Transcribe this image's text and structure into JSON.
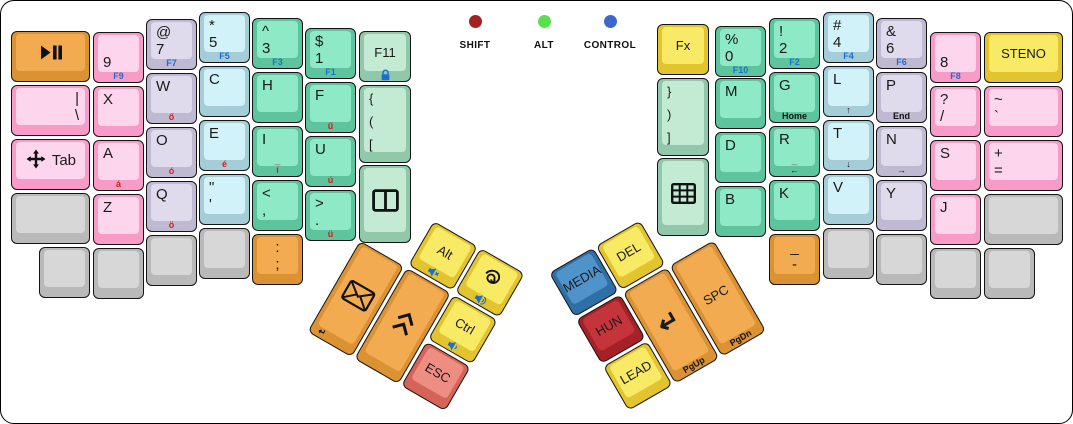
{
  "canvas": {
    "width": 1071,
    "height": 422,
    "background": "#ffffff",
    "border": "#000000"
  },
  "palette": {
    "orange": {
      "side": "#db9232",
      "face": "#f2ab51"
    },
    "pink": {
      "side": "#f89bc6",
      "face": "#fdd6ed"
    },
    "lavender": {
      "side": "#bfb9d1",
      "face": "#dfdbec"
    },
    "cyan": {
      "side": "#a5cdd8",
      "face": "#d0f2f8"
    },
    "green": {
      "side": "#5ec49e",
      "face": "#8ee9c6"
    },
    "ltgreen": {
      "side": "#92c8aa",
      "face": "#c3ebd4"
    },
    "yellow": {
      "side": "#e2c42e",
      "face": "#f8ea65"
    },
    "salmon": {
      "side": "#d56358",
      "face": "#ee8d82"
    },
    "blue": {
      "side": "#2e6fa8",
      "face": "#4f93ca"
    },
    "darkred": {
      "side": "#a52027",
      "face": "#c5343a"
    },
    "gray": {
      "side": "#b9b9b9",
      "face": "#d7d7d7"
    }
  },
  "legend_colors": {
    "function_labels": "#1b6ed2",
    "hungarian_accents": "#d11f1f",
    "nav_labels": "#111111"
  },
  "indicators": {
    "items": [
      {
        "name": "shift",
        "label": "SHIFT",
        "color": "#a42221",
        "x": 434
      },
      {
        "name": "alt",
        "label": "ALT",
        "color": "#57e14f",
        "x": 503
      },
      {
        "name": "control",
        "label": "CONTROL",
        "color": "#3c67cb",
        "x": 569
      }
    ]
  },
  "keys": [
    {
      "name": "key-play-pause",
      "x": 10,
      "y": 30,
      "w": 79,
      "color": "orange",
      "icon": "play-pause"
    },
    {
      "name": "key-9",
      "x": 92,
      "y": 31,
      "color": "pink",
      "lines": [
        "",
        "9"
      ],
      "lip": "F9",
      "lipColor": "blue"
    },
    {
      "name": "key-at-7",
      "x": 145,
      "y": 18,
      "color": "lavender",
      "lines": [
        "@",
        "7"
      ],
      "lip": "F7",
      "lipColor": "blue"
    },
    {
      "name": "key-star-5",
      "x": 198,
      "y": 11,
      "color": "cyan",
      "lines": [
        "*",
        "5"
      ],
      "lip": "F5",
      "lipColor": "blue"
    },
    {
      "name": "key-caret-3",
      "x": 251,
      "y": 17,
      "color": "green",
      "lines": [
        "^",
        "3"
      ],
      "lip": "F3",
      "lipColor": "blue"
    },
    {
      "name": "key-dollar-1",
      "x": 304,
      "y": 27,
      "color": "green",
      "lines": [
        "$",
        "1"
      ],
      "lip": "F1",
      "lipColor": "blue"
    },
    {
      "name": "key-f11",
      "x": 358,
      "y": 30,
      "w": 52,
      "color": "ltgreen",
      "lines": [
        "F11"
      ],
      "middle": true,
      "align": "center",
      "lipIcon": "lock"
    },
    {
      "name": "key-pipe-backslash",
      "x": 10,
      "y": 84,
      "w": 79,
      "color": "pink",
      "lines": [
        "|",
        "\\"
      ],
      "align": "right"
    },
    {
      "name": "key-x",
      "x": 92,
      "y": 85,
      "color": "pink",
      "lines": [
        "X"
      ]
    },
    {
      "name": "key-w",
      "x": 145,
      "y": 72,
      "color": "lavender",
      "lines": [
        "W"
      ],
      "lip": "ő",
      "lipColor": "red"
    },
    {
      "name": "key-c",
      "x": 198,
      "y": 65,
      "color": "cyan",
      "lines": [
        "C"
      ]
    },
    {
      "name": "key-h",
      "x": 251,
      "y": 71,
      "color": "green",
      "lines": [
        "H"
      ]
    },
    {
      "name": "key-f",
      "x": 304,
      "y": 81,
      "color": "green",
      "lines": [
        "F"
      ],
      "lip": "ű",
      "lipColor": "red"
    },
    {
      "name": "key-open-brackets",
      "x": 358,
      "y": 84,
      "w": 52,
      "h": 78,
      "color": "ltgreen",
      "lines": [
        "{",
        "(",
        "["
      ]
    },
    {
      "name": "key-tab",
      "x": 10,
      "y": 138,
      "w": 79,
      "color": "pink",
      "icon": "move",
      "iconRowText": "Tab"
    },
    {
      "name": "key-a",
      "x": 92,
      "y": 139,
      "color": "pink",
      "lines": [
        "A"
      ],
      "lip": "á",
      "lipColor": "red"
    },
    {
      "name": "key-o",
      "x": 145,
      "y": 126,
      "color": "lavender",
      "lines": [
        "O"
      ],
      "lip": "ó",
      "lipColor": "red"
    },
    {
      "name": "key-e",
      "x": 198,
      "y": 119,
      "color": "cyan",
      "lines": [
        "E"
      ],
      "lip": "é",
      "lipColor": "red"
    },
    {
      "name": "key-i",
      "x": 251,
      "y": 125,
      "color": "green",
      "lines": [
        "I"
      ],
      "faceBottom": "_",
      "lip": "í",
      "lipColor": "red"
    },
    {
      "name": "key-u",
      "x": 304,
      "y": 135,
      "color": "green",
      "lines": [
        "U"
      ],
      "lip": "ú",
      "lipColor": "red"
    },
    {
      "name": "key-window-split",
      "x": 358,
      "y": 164,
      "w": 52,
      "h": 78,
      "color": "ltgreen",
      "icon": "window"
    },
    {
      "name": "key-blank-left-mod",
      "x": 10,
      "y": 192,
      "w": 79,
      "color": "gray"
    },
    {
      "name": "key-z",
      "x": 92,
      "y": 193,
      "color": "pink",
      "lines": [
        "Z"
      ]
    },
    {
      "name": "key-q",
      "x": 145,
      "y": 180,
      "color": "lavender",
      "lines": [
        "Q"
      ],
      "lip": "ö",
      "lipColor": "red"
    },
    {
      "name": "key-quote",
      "x": 198,
      "y": 173,
      "color": "cyan",
      "lines": [
        "\"",
        "'"
      ]
    },
    {
      "name": "key-less-comma",
      "x": 251,
      "y": 179,
      "color": "green",
      "lines": [
        "<",
        ","
      ]
    },
    {
      "name": "key-greater-period",
      "x": 304,
      "y": 189,
      "color": "green",
      "lines": [
        ">",
        "."
      ],
      "lip": "ü",
      "lipColor": "red"
    },
    {
      "name": "key-blank-lb1",
      "x": 38,
      "y": 246,
      "color": "gray"
    },
    {
      "name": "key-blank-lb2",
      "x": 92,
      "y": 247,
      "color": "gray"
    },
    {
      "name": "key-blank-lb3",
      "x": 145,
      "y": 234,
      "color": "gray"
    },
    {
      "name": "key-blank-lb4",
      "x": 198,
      "y": 227,
      "color": "gray"
    },
    {
      "name": "key-colon-semicolon",
      "x": 251,
      "y": 233,
      "color": "orange",
      "lines": [
        ":",
        ";"
      ],
      "align": "center"
    },
    {
      "name": "key-fx",
      "x": 656,
      "y": 23,
      "w": 52,
      "color": "yellow",
      "lines": [
        "Fx"
      ],
      "middle": true,
      "align": "center"
    },
    {
      "name": "key-percent-0",
      "x": 714,
      "y": 25,
      "color": "green",
      "lines": [
        "%",
        "0"
      ],
      "lip": "F10",
      "lipColor": "blue"
    },
    {
      "name": "key-excl-2",
      "x": 768,
      "y": 17,
      "color": "green",
      "lines": [
        "!",
        "2"
      ],
      "lip": "F2",
      "lipColor": "blue"
    },
    {
      "name": "key-hash-4",
      "x": 822,
      "y": 11,
      "color": "cyan",
      "lines": [
        "#",
        "4"
      ],
      "lip": "F4",
      "lipColor": "blue"
    },
    {
      "name": "key-amp-6",
      "x": 875,
      "y": 17,
      "color": "lavender",
      "lines": [
        "&",
        "6"
      ],
      "lip": "F6",
      "lipColor": "blue"
    },
    {
      "name": "key-8",
      "x": 929,
      "y": 31,
      "color": "pink",
      "lines": [
        "",
        "8"
      ],
      "lip": "F8",
      "lipColor": "blue"
    },
    {
      "name": "key-steno",
      "x": 983,
      "y": 31,
      "w": 79,
      "color": "yellow",
      "lines": [
        "STENO"
      ],
      "middle": true,
      "align": "center"
    },
    {
      "name": "key-close-brackets",
      "x": 656,
      "y": 77,
      "w": 52,
      "h": 78,
      "color": "ltgreen",
      "lines": [
        "}",
        ")",
        "]"
      ]
    },
    {
      "name": "key-m",
      "x": 714,
      "y": 77,
      "color": "green",
      "lines": [
        "M"
      ]
    },
    {
      "name": "key-g",
      "x": 768,
      "y": 71,
      "color": "green",
      "lines": [
        "G"
      ],
      "lip": "Home",
      "lipColor": "black"
    },
    {
      "name": "key-l",
      "x": 822,
      "y": 65,
      "color": "cyan",
      "lines": [
        "L"
      ],
      "lip": "↑",
      "lipColor": "black"
    },
    {
      "name": "key-p",
      "x": 875,
      "y": 71,
      "color": "lavender",
      "lines": [
        "P"
      ],
      "lip": "End",
      "lipColor": "black"
    },
    {
      "name": "key-question-slash",
      "x": 929,
      "y": 85,
      "color": "pink",
      "lines": [
        "?",
        "/"
      ]
    },
    {
      "name": "key-tilde-backtick",
      "x": 983,
      "y": 85,
      "w": 79,
      "color": "pink",
      "lines": [
        "~",
        "`"
      ]
    },
    {
      "name": "key-keypad-grid",
      "x": 656,
      "y": 157,
      "w": 52,
      "h": 78,
      "color": "ltgreen",
      "icon": "grid"
    },
    {
      "name": "key-d",
      "x": 714,
      "y": 131,
      "color": "green",
      "lines": [
        "D"
      ]
    },
    {
      "name": "key-r",
      "x": 768,
      "y": 125,
      "color": "green",
      "lines": [
        "R"
      ],
      "faceBottom": "_",
      "lip": "←",
      "lipColor": "black"
    },
    {
      "name": "key-t",
      "x": 822,
      "y": 119,
      "color": "cyan",
      "lines": [
        "T"
      ],
      "lip": "↓",
      "lipColor": "black"
    },
    {
      "name": "key-n",
      "x": 875,
      "y": 125,
      "color": "lavender",
      "lines": [
        "N"
      ],
      "lip": "→",
      "lipColor": "black"
    },
    {
      "name": "key-s",
      "x": 929,
      "y": 139,
      "color": "pink",
      "lines": [
        "S"
      ]
    },
    {
      "name": "key-plus-equals",
      "x": 983,
      "y": 139,
      "w": 79,
      "color": "pink",
      "lines": [
        "+",
        "="
      ]
    },
    {
      "name": "key-b",
      "x": 714,
      "y": 185,
      "color": "green",
      "lines": [
        "B"
      ]
    },
    {
      "name": "key-k",
      "x": 768,
      "y": 179,
      "color": "green",
      "lines": [
        "K"
      ]
    },
    {
      "name": "key-v",
      "x": 822,
      "y": 173,
      "color": "cyan",
      "lines": [
        "V"
      ]
    },
    {
      "name": "key-y",
      "x": 875,
      "y": 179,
      "color": "lavender",
      "lines": [
        "Y"
      ]
    },
    {
      "name": "key-j",
      "x": 929,
      "y": 193,
      "color": "pink",
      "lines": [
        "J"
      ]
    },
    {
      "name": "key-blank-right-mod",
      "x": 983,
      "y": 193,
      "w": 79,
      "color": "gray"
    },
    {
      "name": "key-underscore-dash",
      "x": 768,
      "y": 233,
      "color": "orange",
      "lines": [
        "_",
        "-"
      ],
      "align": "center"
    },
    {
      "name": "key-blank-rb2",
      "x": 822,
      "y": 227,
      "color": "gray"
    },
    {
      "name": "key-blank-rb3",
      "x": 875,
      "y": 233,
      "color": "gray"
    },
    {
      "name": "key-blank-rb4",
      "x": 929,
      "y": 247,
      "color": "gray"
    },
    {
      "name": "key-blank-rb5",
      "x": 983,
      "y": 247,
      "color": "gray"
    }
  ],
  "clusters": [
    {
      "name": "left-thumb-cluster",
      "x": 386,
      "y": 193,
      "rotation": 30,
      "keys": [
        {
          "name": "key-alt",
          "x": 54,
          "y": 0,
          "color": "yellow",
          "lines": [
            "Alt"
          ],
          "middle": true,
          "align": "center",
          "lipIcon": "vol-mute"
        },
        {
          "name": "key-redo-spiral",
          "x": 108,
          "y": 0,
          "color": "yellow",
          "icon": "spiral",
          "lipIcon": "vol-up"
        },
        {
          "name": "key-mail",
          "x": 0,
          "y": 54,
          "h": 105,
          "color": "orange",
          "icon": "envelope",
          "lip": "↵",
          "lipColor": "black",
          "lipAlign": "left"
        },
        {
          "name": "key-page-chevrons",
          "x": 54,
          "y": 54,
          "h": 105,
          "color": "orange",
          "icon": "chevron2"
        },
        {
          "name": "key-ctrl",
          "x": 108,
          "y": 54,
          "color": "yellow",
          "lines": [
            "Ctrl"
          ],
          "middle": true,
          "align": "center",
          "lipIcon": "vol-down"
        },
        {
          "name": "key-esc",
          "x": 108,
          "y": 108,
          "color": "salmon",
          "lines": [
            "ESC"
          ],
          "middle": true,
          "align": "center"
        }
      ]
    },
    {
      "name": "right-thumb-cluster",
      "x": 548,
      "y": 272,
      "rotation": -30,
      "keys": [
        {
          "name": "key-media",
          "x": 0,
          "y": 0,
          "color": "blue",
          "lines": [
            "MEDIA"
          ],
          "middle": true,
          "align": "center"
        },
        {
          "name": "key-del",
          "x": 54,
          "y": 0,
          "color": "yellow",
          "lines": [
            "DEL"
          ],
          "middle": true,
          "align": "center"
        },
        {
          "name": "key-hun",
          "x": 0,
          "y": 54,
          "color": "darkred",
          "lines": [
            "HUN"
          ],
          "middle": true,
          "align": "center"
        },
        {
          "name": "key-lead",
          "x": 0,
          "y": 108,
          "color": "yellow",
          "lines": [
            "LEAD"
          ],
          "middle": true,
          "align": "center"
        },
        {
          "name": "key-enter",
          "x": 54,
          "y": 54,
          "h": 105,
          "color": "orange",
          "lines": [
            "↵"
          ],
          "middle": true,
          "align": "center",
          "big": true,
          "lip": "PgUp",
          "lipColor": "black"
        },
        {
          "name": "key-space",
          "x": 108,
          "y": 54,
          "h": 105,
          "color": "orange",
          "lines": [
            "SPC"
          ],
          "middle": true,
          "align": "center",
          "lip": "PgDn",
          "lipColor": "black"
        }
      ]
    }
  ]
}
